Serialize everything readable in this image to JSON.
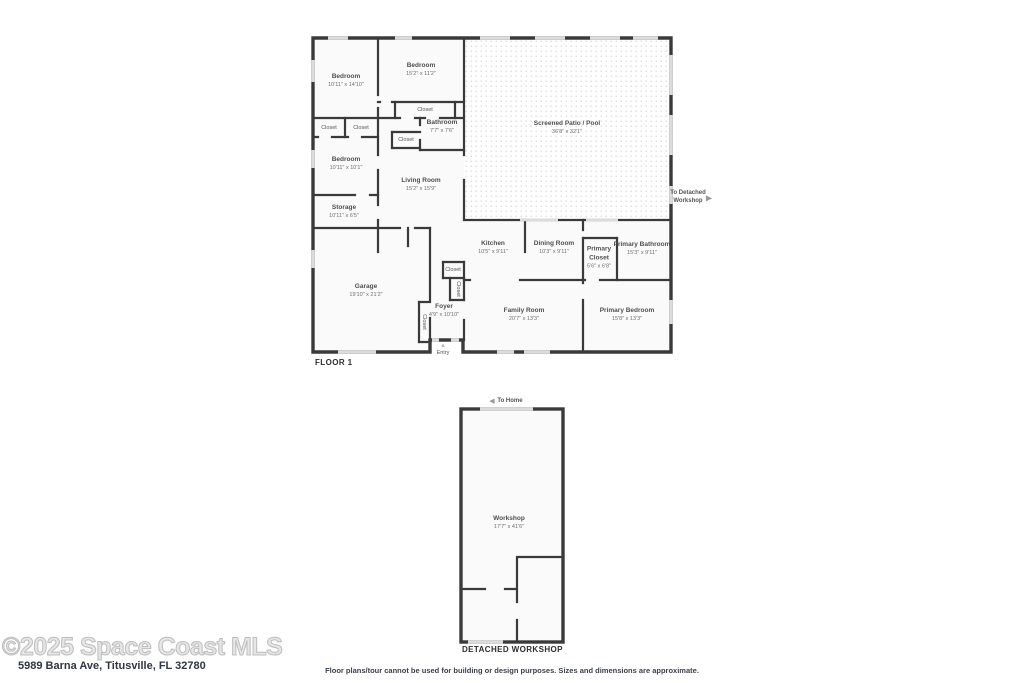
{
  "floor1": {
    "label": "FLOOR 1",
    "closet_label": "Closet",
    "entry_label": "Entry",
    "to_detached_label": "To Detached Workshop",
    "rooms": {
      "bedroom_top_left": {
        "name": "Bedroom",
        "dims": "10'11\" x 14'10\""
      },
      "bedroom_top_mid": {
        "name": "Bedroom",
        "dims": "15'2\" x 11'2\""
      },
      "bathroom": {
        "name": "Bathroom",
        "dims": "7'7\" x 7'6\""
      },
      "bedroom_left": {
        "name": "Bedroom",
        "dims": "10'11\" x 10'1\""
      },
      "storage": {
        "name": "Storage",
        "dims": "10'11\" x 6'5\""
      },
      "living_room": {
        "name": "Living Room",
        "dims": "15'2\" x 15'9\""
      },
      "screened_patio": {
        "name": "Screened Patio / Pool",
        "dims": "36'8\" x 32'1\""
      },
      "kitchen": {
        "name": "Kitchen",
        "dims": "10'5\" x 9'11\""
      },
      "dining_room": {
        "name": "Dining Room",
        "dims": "10'3\" x 9'11\""
      },
      "primary_closet": {
        "name": "Primary Closet",
        "dims": "5'6\" x 6'8\""
      },
      "primary_bathroom": {
        "name": "Primary Bathroom",
        "dims": "15'3\" x 9'11\""
      },
      "garage": {
        "name": "Garage",
        "dims": "19'10\" x 21'2\""
      },
      "foyer": {
        "name": "Foyer",
        "dims": "4'9\" x 10'10\""
      },
      "family_room": {
        "name": "Family Room",
        "dims": "20'7\" x 13'3\""
      },
      "primary_bedroom": {
        "name": "Primary Bedroom",
        "dims": "15'8\" x 13'3\""
      }
    },
    "icons": {
      "to_detached_arrow": "right-triangle",
      "entry_marker": "up-triangle"
    }
  },
  "workshop_plan": {
    "label": "DETACHED WORKSHOP",
    "to_home_label": "To Home",
    "room": {
      "name": "Workshop",
      "dims": "17'7\" x 41'6\""
    },
    "icons": {
      "to_home_arrow": "left-triangle"
    }
  },
  "footer": {
    "watermark": "©2025 Space Coast MLS",
    "address": "5989 Barna Ave, Titusville, FL 32780",
    "disclaimer": "Floor plans/tour cannot be used for building or design purposes. Sizes and dimensions are approximate."
  },
  "colors": {
    "wall": "#3a3a3a",
    "window": "#dcdcdc",
    "room_fill": "#fafafa",
    "patio_dot": "#d2d2d2",
    "label_text": "#4f4f4f"
  }
}
